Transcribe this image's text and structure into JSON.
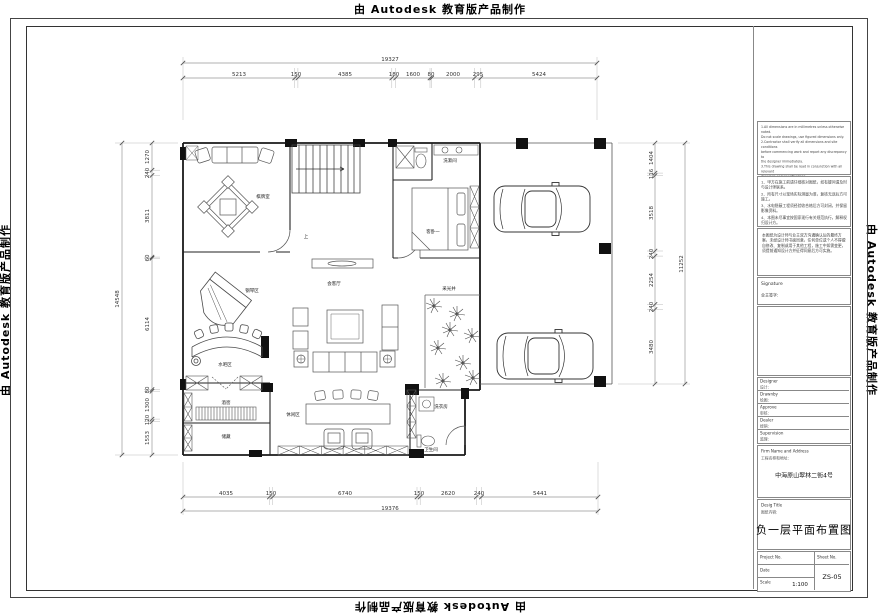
{
  "watermarks": {
    "top": "由 Autodesk 教育版产品制作",
    "bottom": "由 Autodesk 教育版产品制作",
    "left": "由 Autodesk 教育版产品制作",
    "right": "由 Autodesk 教育版产品制作"
  },
  "dimensions": {
    "top": {
      "total": "19327",
      "segments": [
        "5213",
        "150",
        "4385",
        "180",
        "1600",
        "80",
        "2000",
        "295",
        "5424"
      ]
    },
    "bottom": {
      "total": "19376",
      "segments": [
        "4035",
        "150",
        "6740",
        "150",
        "2620",
        "240",
        "5441"
      ]
    },
    "left": {
      "total": "14548",
      "segments": [
        "1270",
        "240",
        "3811",
        "60",
        "6114",
        "80",
        "1300",
        "120",
        "1553"
      ]
    },
    "right": {
      "total": "11252",
      "segments": [
        "1404",
        "116",
        "3518",
        "240",
        "2254",
        "240",
        "3480"
      ]
    }
  },
  "rooms": {
    "card_room": "棋牌室",
    "wash_room": "洗漱间",
    "guest_bedroom": "客卧一",
    "living_room": "会客厅",
    "lightwell": "采光井",
    "piano_area": "钢琴区",
    "bar_area": "水吧区",
    "wine_cellar": "酒窖",
    "storage": "储藏",
    "leisure_area": "休闲区",
    "laundry": "洗衣房",
    "toilet": "卫生间",
    "stair_up": "上"
  },
  "title_block": {
    "notes_en": [
      "1.All dimensions are in millimetres unless otherwise noted.",
      "  Do not scale drawings, use figured dimensions only.",
      "2.Contractor shall verify all dimensions and site conditions",
      "  before commencing work and report any discrepancy to",
      "  the designer immediately.",
      "3.This drawing shall be read in conjunction with all relevant",
      "  drawings and specifications.",
      "4.Any amendment must be approved by the designer in",
      "  writing before construction."
    ],
    "notes_cn": [
      "1、甲方在施工前请仔细核对图纸，如有疑问请及时与设计师联系。",
      "2、所有尺寸以现场实际测量为准，复核无误后方可施工。",
      "3、水电隐蔽工程须经验收合格后方可封闭，并保留影像资料。",
      "4、本图未尽事宜按国家现行有关规范执行，解释权归设计方。"
    ],
    "notes_paragraph": "本图纸为设计师与业主双方沟通确认后的最终方案，未经设计师书面同意，任何单位或个人不得擅自修改、复制或用于其他工程，施工中如需变更，须提前通知设计方并征得同意后方可实施。",
    "signature": {
      "en": "Signature",
      "cn": "业主签字:"
    },
    "roles": [
      {
        "en": "Designer",
        "cn": "设计:"
      },
      {
        "en": "Drawnby",
        "cn": "绘图:"
      },
      {
        "en": "Approve",
        "cn": "审核:"
      },
      {
        "en": "Dealer",
        "cn": "经销:"
      },
      {
        "en": "Supervision",
        "cn": "监理:"
      }
    ],
    "firm": {
      "en": "Firm Name and Address",
      "cn": "工程名称和地址:",
      "value": "中海原山翠林二街4号"
    },
    "design_title": {
      "en": "Desig Title",
      "cn": "图纸内容:",
      "value": "负一层平面布置图"
    },
    "project_no_label": "Project No.",
    "sheet_no_label": "Sheet No.",
    "date_label": "Date",
    "scale_label": "Scale",
    "scale_value": "1:100",
    "sheet_no_value": "ZS-05"
  }
}
